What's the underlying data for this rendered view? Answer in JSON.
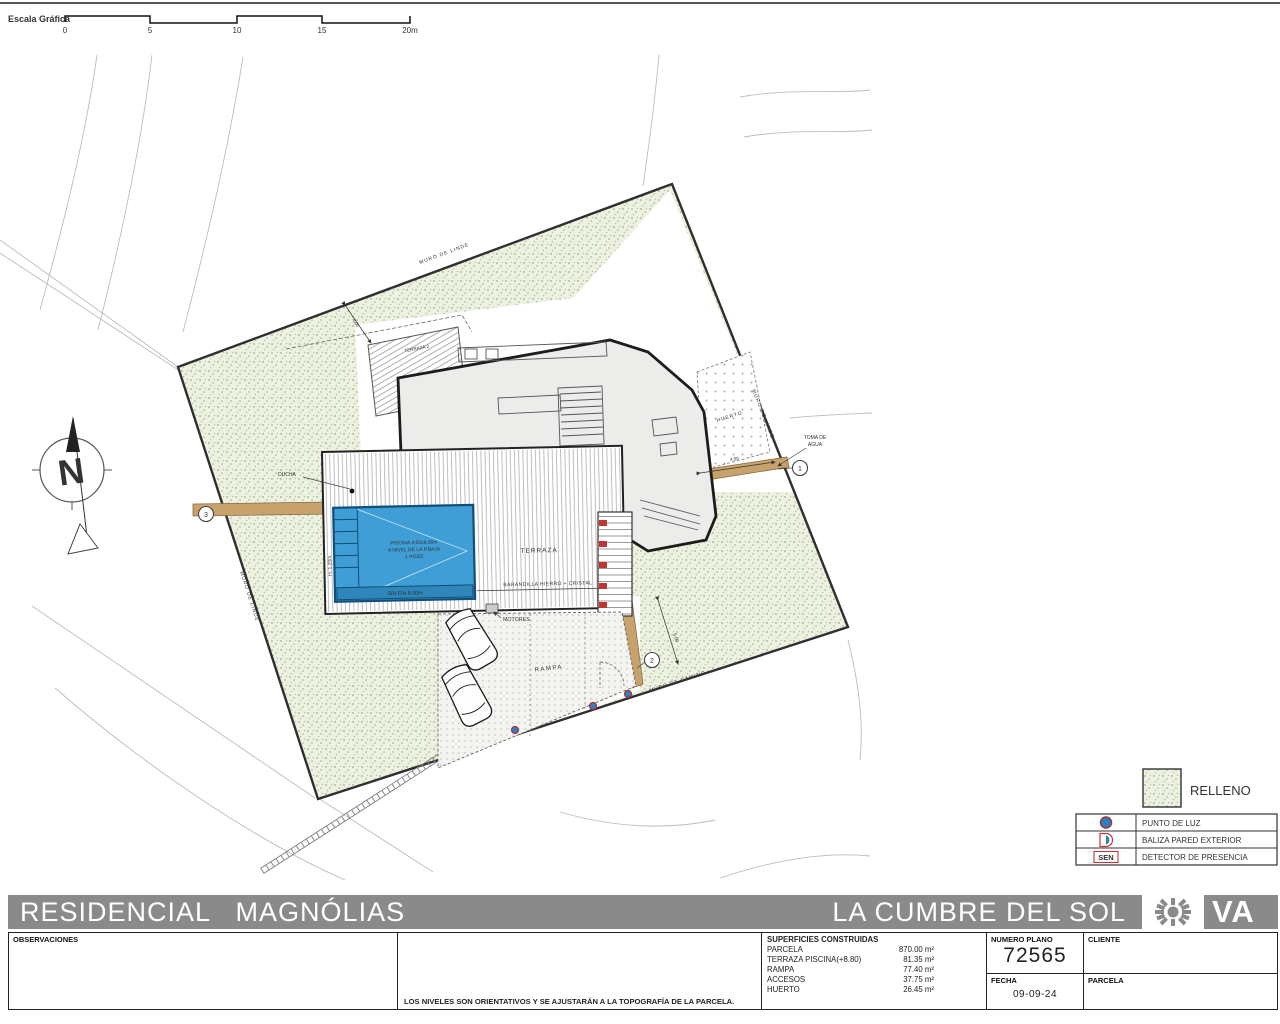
{
  "colors": {
    "banner_gray": "#8a8a8a",
    "pool_blue": "#3f9ed6",
    "relleno_green": "#a3b487",
    "path_tan": "#c8a26b",
    "marker_red": "#c23333",
    "dot_blue": "#2b7fc2"
  },
  "scale_bar": {
    "label": "Escala Gráfica",
    "ticks": [
      "0",
      "5",
      "10",
      "15",
      "20m"
    ]
  },
  "compass": {
    "north": "N"
  },
  "plan": {
    "walls": {
      "linde_top": "MURO DE LINDE",
      "linde_right": "MURO DE LINDE",
      "linde_left": "MURO DE LINDE",
      "camino": "MURO DE CAMINO"
    },
    "areas": {
      "terraza2": "TERRAZA 2",
      "terraza": "TERRAZA",
      "huerto": "HUERTO",
      "rampa": "RAMPA"
    },
    "pool": {
      "line1": "PISCINA 4.00x8.00m",
      "line2": "A NIVEL DE LA P.BAJA",
      "line3": "1 POZO",
      "sinfin": "SIN FIN 8.00m",
      "height": "H: 1.20m"
    },
    "callouts": {
      "ducha": "DUCHA",
      "toma1": "TOMA DE",
      "toma2": "AGUA",
      "motores": "MOTORES",
      "barandilla": "BARANDILLA HIERRO + CRISTAL"
    },
    "dims": {
      "d1": "4.00",
      "d2": "4.00",
      "d3": "5.00"
    },
    "markers": {
      "m1": "1",
      "m2": "2",
      "m3": "3"
    }
  },
  "legend": {
    "relleno": "RELLENO",
    "sen": "SEN",
    "rows": [
      {
        "icon": "light-point",
        "label": "PUNTO DE LUZ"
      },
      {
        "icon": "wall-beacon",
        "label": "BALIZA PARED EXTERIOR"
      },
      {
        "icon": "presence-detector",
        "label": "DETECTOR DE PRESENCIA"
      }
    ]
  },
  "title_block": {
    "project": "RESIDENCIAL   MAGNÓLIAS",
    "location": "LA CUMBRE DEL SOL",
    "logo_text": "VA",
    "observaciones_label": "OBSERVACIONES",
    "note": "LOS NIVELES SON ORIENTATIVOS Y SE AJUSTARÁN A LA TOPOGRAFÍA DE LA PARCELA.",
    "superficies": {
      "header": "SUPERFICIES CONSTRUIDAS",
      "rows": [
        {
          "label": "PARCELA",
          "value": "870.00 m²"
        },
        {
          "label": "TERRAZA PISCINA(+8.80)",
          "value": "81.35 m²"
        },
        {
          "label": "RAMPA",
          "value": "77.40 m²"
        },
        {
          "label": "ACCESOS",
          "value": "37.75 m²"
        },
        {
          "label": "HUERTO",
          "value": "26.45 m²"
        }
      ]
    },
    "numero_plano": {
      "label": "NUMERO PLANO",
      "value": "72565"
    },
    "fecha": {
      "label": "FECHA",
      "value": "09-09-24"
    },
    "cliente_label": "CLIENTE",
    "parcela_label": "PARCELA"
  }
}
